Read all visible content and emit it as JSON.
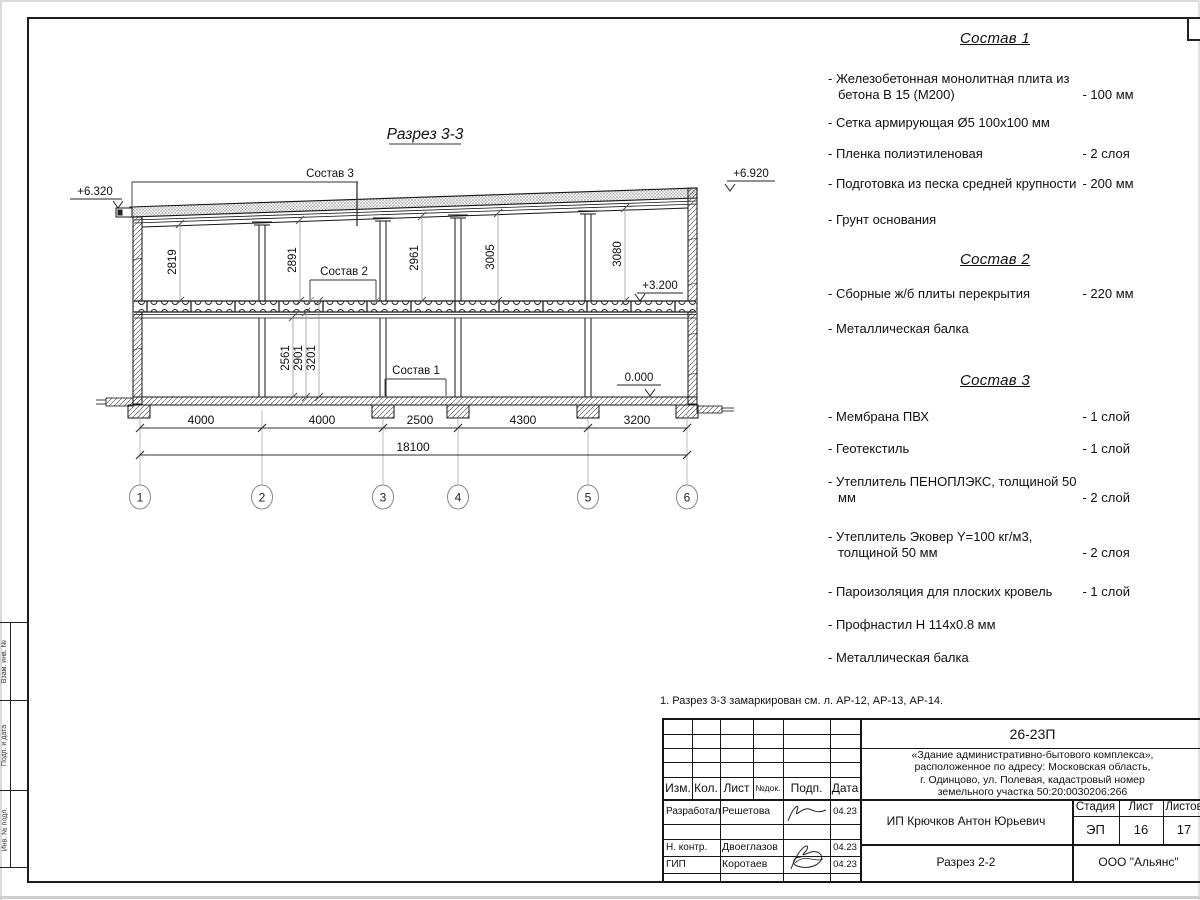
{
  "section": {
    "title": "Разрез 3-3",
    "labels": {
      "s3": "Состав 3",
      "s2": "Состав 2",
      "s1": "Состав 1"
    },
    "elevations": {
      "roof_left": "+6.320",
      "roof_right": "+6.920",
      "floor": "+3.200",
      "ground": "0.000"
    },
    "dims_upper": [
      "2819",
      "2891",
      "2961",
      "3005",
      "3080"
    ],
    "dims_lower": [
      "2561",
      "2901",
      "3201"
    ],
    "dims_bottom": [
      "4000",
      "4000",
      "2500",
      "4300",
      "3200"
    ],
    "dim_total": "18100",
    "axes": [
      "1",
      "2",
      "3",
      "4",
      "5",
      "6"
    ]
  },
  "compositions": [
    {
      "title": "Состав 1",
      "items": [
        {
          "text": "- Железобетонная  монолитная плита из бетона В 15 (М200)",
          "value": "- 100 мм"
        },
        {
          "text": "- Сетка армирующая Ø5 100х100 мм",
          "value": ""
        },
        {
          "text": "- Пленка полиэтиленовая",
          "value": "-  2 слоя"
        },
        {
          "text": "- Подготовка из песка средней крупности",
          "value": "- 200 мм"
        },
        {
          "text": "- Грунт основания",
          "value": ""
        }
      ]
    },
    {
      "title": "Состав 2",
      "items": [
        {
          "text": "- Сборные ж/б плиты перекрытия",
          "value": "- 220 мм"
        },
        {
          "text": "- Металлическая балка",
          "value": ""
        }
      ]
    },
    {
      "title": "Состав 3",
      "items": [
        {
          "text": "- Мембрана ПВХ",
          "value": "- 1 слой"
        },
        {
          "text": "- Геотекстиль",
          "value": "- 1 слой"
        },
        {
          "text": "- Утеплитель ПЕНОПЛЭКС, толщиной 50 мм",
          "value": "- 2 слой"
        },
        {
          "text": "- Утеплитель Эковер Y=100 кг/м3, толщиной 50 мм",
          "value": "- 2 слоя"
        },
        {
          "text": "- Пароизоляция для плоских кровель",
          "value": "- 1 слой"
        },
        {
          "text": "- Профнастил Н 114х0.8 мм",
          "value": ""
        },
        {
          "text": "- Металлическая балка",
          "value": ""
        }
      ]
    }
  ],
  "note": "1. Разрез 3-3 замаркирован см. л. АР-12, АР-13, АР-14.",
  "titleblock": {
    "doc_number": "26-23П",
    "project_lines": [
      "«Здание административно-бытового комплекса»,",
      "расположенное по адресу: Московская область,",
      "г. Одинцово, ул. Полевая, кадастровый номер",
      "земельного участка 50:20:0030206:266"
    ],
    "header_cols": [
      "Изм.",
      "Кол.",
      "Лист",
      "№док.",
      "Подп.",
      "Дата"
    ],
    "rows": [
      {
        "role": "Разработал",
        "name": "Решетова",
        "date": "04.23"
      },
      {
        "role": "Н. контр.",
        "name": "Двоеглазов",
        "date": "04.23"
      },
      {
        "role": "ГИП",
        "name": "Коротаев",
        "date": "04.23"
      }
    ],
    "client": "ИП Крючков Антон Юрьевич",
    "stage_label": "Стадия",
    "sheet_label": "Лист",
    "sheets_label": "Листов",
    "stage": "ЭП",
    "sheet": "16",
    "sheets": "17",
    "drawing_name": "Разрез 2-2",
    "company": "ООО \"Альянс\""
  },
  "side_stamps": [
    "Взам. инв. №",
    "Подп. и дата",
    "Инв. № подл."
  ]
}
